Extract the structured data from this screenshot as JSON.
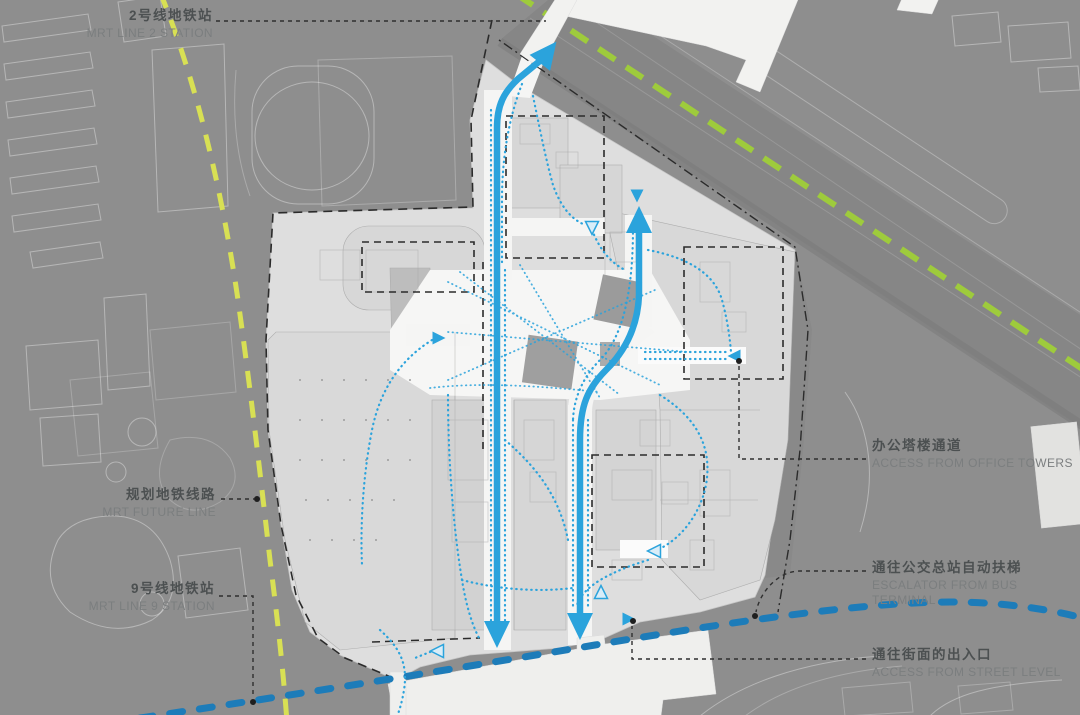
{
  "diagram": {
    "type": "architectural-site-circulation-plan",
    "annotations": {
      "mrt_line_2_station": {
        "cn": "2号线地铁站",
        "en": "MRT LINE 2 STATION"
      },
      "mrt_future_line": {
        "cn": "规划地铁线路",
        "en": "MRT FUTURE LINE"
      },
      "mrt_line_9_station": {
        "cn": "9号线地铁站",
        "en": "MRT LINE 9 STATION"
      },
      "office_tower_access": {
        "cn": "办公塔楼通道",
        "en": "ACCESS FROM OFFICE TOWERS"
      },
      "bus_terminal_escalator": {
        "cn": "通往公交总站自动扶梯",
        "en": "ESCALATOR FROM BUS TERMINAL"
      },
      "street_level_access": {
        "cn": "通往街面的出入口",
        "en": "ACCESS FROM STREET LEVEL"
      }
    },
    "colors": {
      "background": "#8e8e8e",
      "site_plan": "#dedede",
      "pedestrian_flow_blue": "#2ba3dc",
      "mrt_line_9_blue": "#1d7cb9",
      "future_line_green": "#9ecb3c",
      "future_line_yellow": "#d8e054",
      "boundary_black": "#2b2b2b",
      "annotation_cn_text": "#4c5051",
      "annotation_en_text": "#7b7e7f"
    },
    "icons": {
      "flow_arrows": [
        "arrow-up-to-mrt-line-2",
        "arrow-up-to-office-towers",
        "arrow-down-to-street-west",
        "arrow-down-to-street-east"
      ],
      "entry_markers": "triangle-entry-marker"
    }
  }
}
